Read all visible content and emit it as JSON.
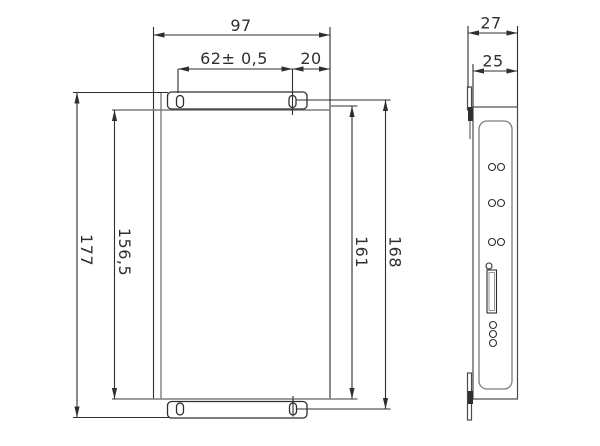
{
  "drawing": {
    "type": "technical-dimension-drawing",
    "views": {
      "front": {
        "dims": {
          "overall_width": "97",
          "slot_spacing_width": "62± 0,5",
          "slot_to_edge": "20",
          "overall_height": "177",
          "body_height": "156,5",
          "slot_to_base_height": "161",
          "slot_spacing_height": "168"
        }
      },
      "side": {
        "dims": {
          "overall_depth": "27",
          "body_depth": "25"
        }
      }
    },
    "colors": {
      "dimension_lines": "#2f2f2f",
      "body_lines": "#7d7d7d",
      "background": "#ffffff"
    }
  }
}
